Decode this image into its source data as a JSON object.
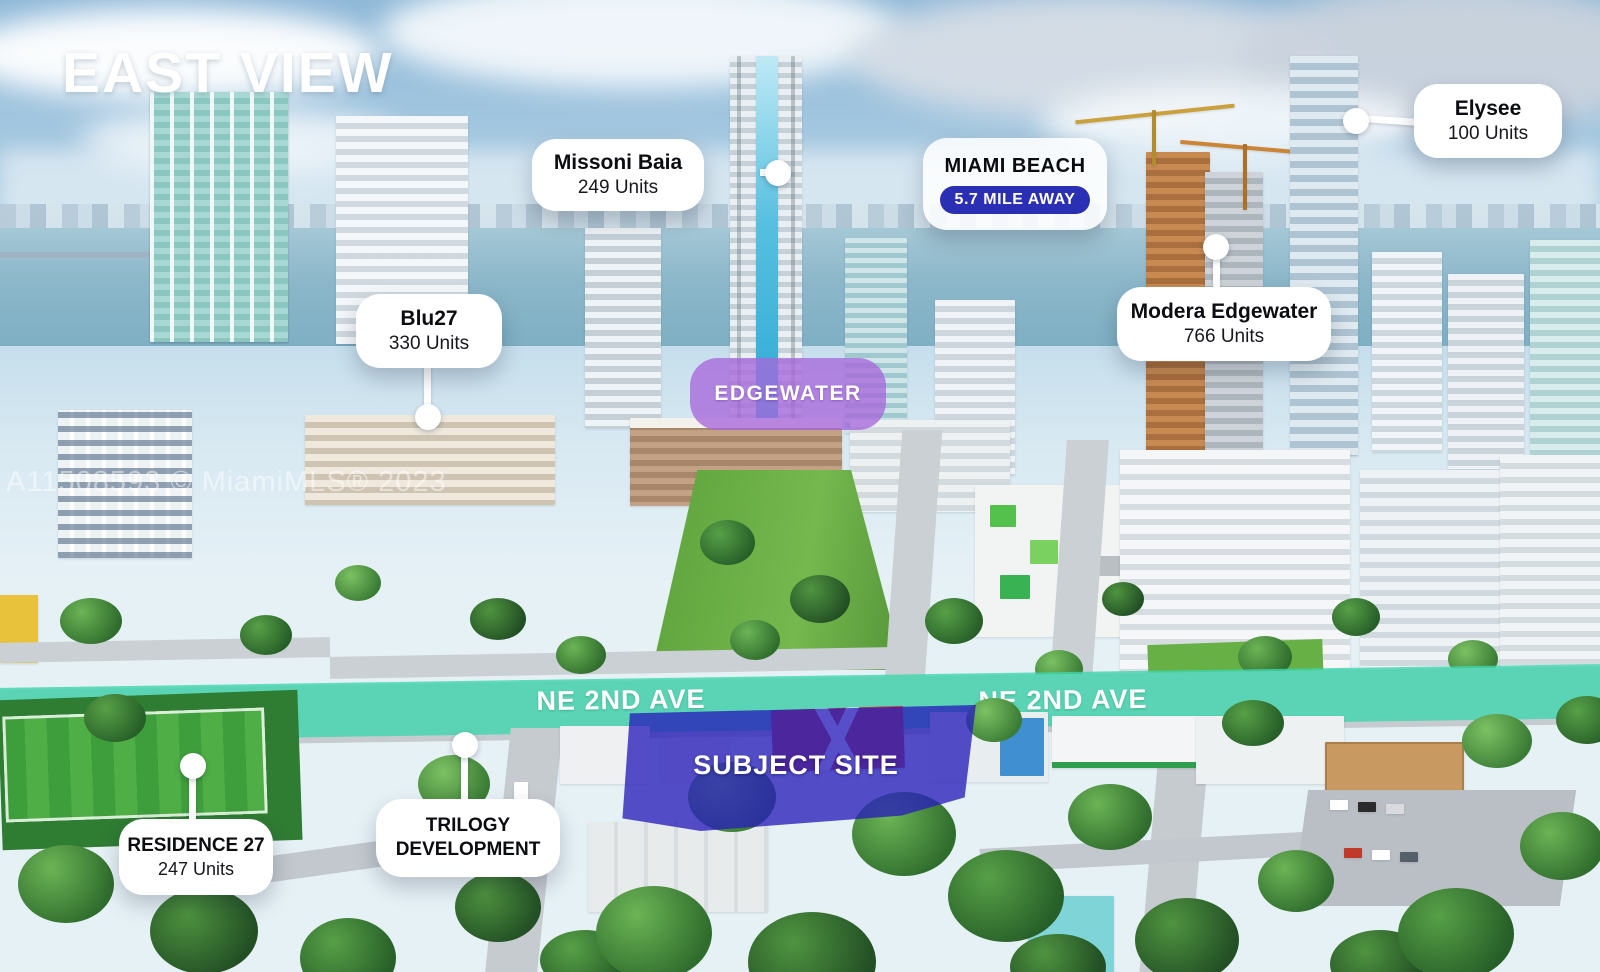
{
  "header": {
    "title": "EAST VIEW"
  },
  "watermark": {
    "text": "A11508593 © MiamiMLS® 2023"
  },
  "street": {
    "labels": [
      "NE 2ND AVE",
      "NE 2ND AVE",
      "NE 2ND AVE"
    ],
    "highlight_color": "#3ed6ae"
  },
  "neighborhood_badge": {
    "label": "EDGEWATER",
    "color": "#a768d9"
  },
  "subject_site": {
    "label": "SUBJECT SITE",
    "color": "#2a1eba"
  },
  "distance_card": {
    "title": "MIAMI BEACH",
    "distance": "5.7 MILE AWAY",
    "pill_color": "#2b2fb4"
  },
  "callouts": [
    {
      "name": "Missoni Baia",
      "units": "249 Units"
    },
    {
      "name": "Blu27",
      "units": "330 Units"
    },
    {
      "name": "Elysee",
      "units": "100 Units"
    },
    {
      "name": "Modera Edgewater",
      "units": "766 Units"
    },
    {
      "name": "RESIDENCE 27",
      "units": "247 Units"
    },
    {
      "name": "TRILOGY DEVELOPMENT",
      "lines": [
        "TRILOGY",
        "DEVELOPMENT"
      ]
    }
  ]
}
